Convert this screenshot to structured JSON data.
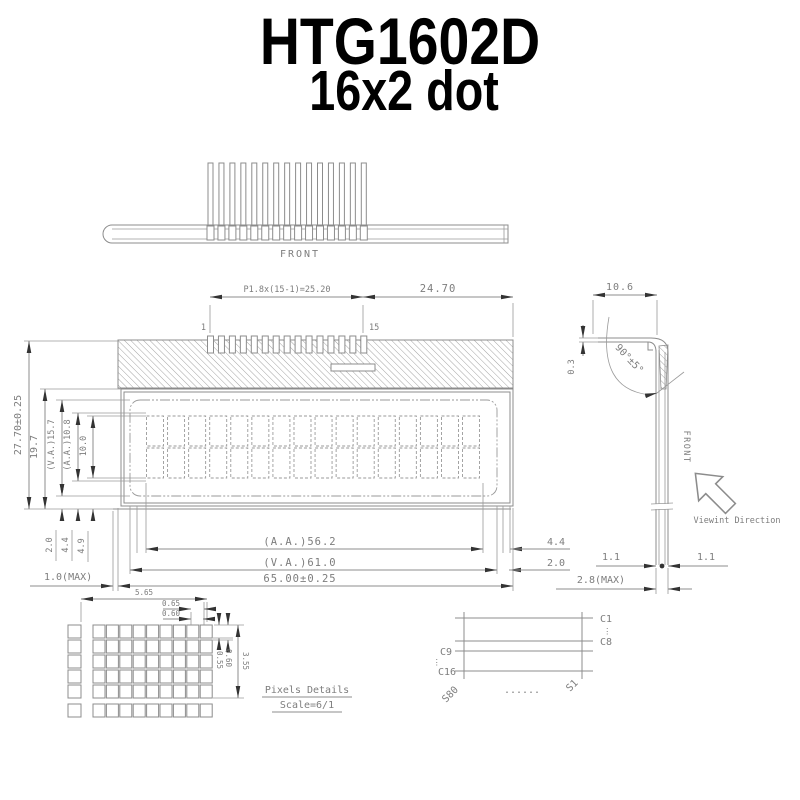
{
  "title": {
    "line1": "HTG1602D",
    "line2": "16x2 dot"
  },
  "top_view": {
    "front_label": "FRONT",
    "pin_count": 15
  },
  "front_view": {
    "pin_first": "1",
    "pin_last": "15",
    "dim_pin_pitch": "P1.8x(15-1)=25.20",
    "dim_top_right": "24.70",
    "columns": 16,
    "rows": 2,
    "dims_left": {
      "overall_height": "27.70±0.25",
      "bezel_height": "19.7",
      "va_height": "(V.A.)15.7",
      "aa_height": "(A.A.)10.8",
      "char_height": "10.0"
    },
    "dims_bottom_left": {
      "offset_va": "2.0",
      "offset_aa": "4.4",
      "offset_char": "4.9",
      "glass_max": "1.0(MAX)"
    },
    "dims_bottom": {
      "aa_width": "(A.A.)56.2",
      "va_width": "(V.A.)61.0",
      "overall_width": "65.00±0.25",
      "right_offset_aa": "4.4",
      "right_offset_va": "2.0"
    }
  },
  "side_view": {
    "dim_width": "10.6",
    "dim_lip": "0.3",
    "dim_angle": "90°±5°",
    "front_label": "FRONT",
    "dim_pin_left": "1.1",
    "dim_pin_right": "1.1",
    "dim_thickness": "2.8(MAX)",
    "viewing_direction": "Viewint Direction"
  },
  "pixel_details": {
    "grid_cols": 9,
    "grid_rows": 5,
    "dim_char_width": "5.65",
    "dim_dot_pitch_x": "0.65",
    "dim_dot_width": "0.60",
    "dim_dot_height": "0.55",
    "dim_dot_pitch_y": "0.60",
    "dim_char_height": "3.55",
    "caption_line1": "Pixels Details",
    "caption_line2": "Scale=6/1"
  },
  "pin_map": {
    "com_first": "C1",
    "com_mid_end": "C8",
    "com_mid_start": "C9",
    "com_last": "C16",
    "seg_last": "S80",
    "seg_first": "S1",
    "h_ellipsis": "......",
    "v_ellipsis": "⋮"
  },
  "colors": {
    "line": "#8c8c8c",
    "text": "#7d7d7d",
    "arrow": "#333333",
    "title": "#000000"
  }
}
